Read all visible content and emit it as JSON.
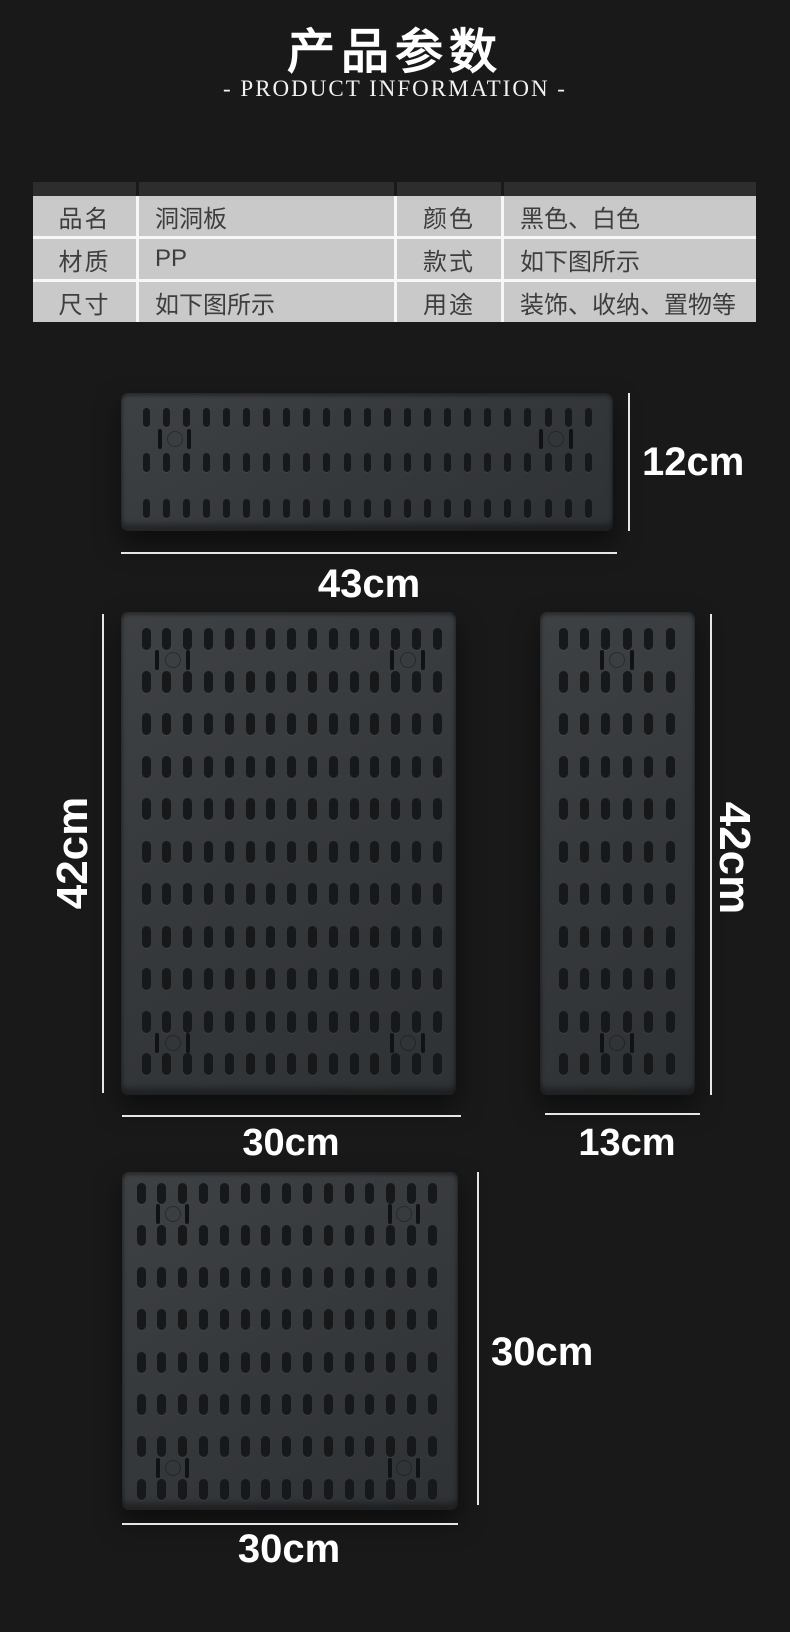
{
  "page": {
    "background": "#191919",
    "panel_gray": "#c9c9c9",
    "board_gray": "#36393c",
    "line_white": "#e6e6e6"
  },
  "header": {
    "title": "产品参数",
    "subtitle": "- PRODUCT INFORMATION -"
  },
  "spec_table": {
    "cells": [
      {
        "label": "品名",
        "value": "洞洞板"
      },
      {
        "label": "颜色",
        "value": "黑色、白色"
      },
      {
        "label": "材质",
        "value": "PP"
      },
      {
        "label": "款式",
        "value": "如下图所示"
      },
      {
        "label": "尺寸",
        "value": "如下图所示"
      },
      {
        "label": "用途",
        "value": "装饰、收纳、置物等"
      }
    ]
  },
  "boards": [
    {
      "name": "pegboard-43x12",
      "width_label": "43cm",
      "height_label": "12cm",
      "x": 121,
      "y": 393,
      "w": 492,
      "h": 138,
      "rows": 3,
      "cols": 23,
      "rowStart": 24,
      "rowPitch": 45.5,
      "colStart": 25,
      "colPitch": 20.1,
      "slotW": 7,
      "slotH": 19,
      "mounts": [
        {
          "y": 46,
          "xs": [
            39,
            68
          ]
        },
        {
          "y": 46,
          "xs": [
            420,
            450
          ]
        }
      ]
    },
    {
      "name": "pegboard-30x42",
      "width_label": "30cm",
      "height_label": "42cm",
      "x": 121,
      "y": 612,
      "w": 335,
      "h": 483,
      "rows": 11,
      "cols": 15,
      "rowStart": 27,
      "rowPitch": 42.5,
      "colStart": 25,
      "colPitch": 20.8,
      "slotW": 9,
      "slotH": 22,
      "mounts": [
        {
          "y": 48,
          "xs": [
            36,
            67
          ]
        },
        {
          "y": 48,
          "xs": [
            271,
            302
          ]
        },
        {
          "y": 431,
          "xs": [
            36,
            67
          ]
        },
        {
          "y": 431,
          "xs": [
            271,
            302
          ]
        }
      ]
    },
    {
      "name": "pegboard-13x42",
      "width_label": "13cm",
      "height_label": "42cm",
      "x": 540,
      "y": 612,
      "w": 155,
      "h": 483,
      "rows": 11,
      "cols": 6,
      "rowStart": 27,
      "rowPitch": 42.5,
      "colStart": 23,
      "colPitch": 21.4,
      "slotW": 9,
      "slotH": 22,
      "mounts": [
        {
          "y": 48,
          "xs": [
            62,
            92
          ]
        },
        {
          "y": 431,
          "xs": [
            62,
            92
          ]
        }
      ]
    },
    {
      "name": "pegboard-30x30",
      "width_label": "30cm",
      "height_label": "30cm",
      "x": 122,
      "y": 1172,
      "w": 336,
      "h": 338,
      "rows": 8,
      "cols": 15,
      "rowStart": 21,
      "rowPitch": 42.3,
      "colStart": 19,
      "colPitch": 20.8,
      "slotW": 9,
      "slotH": 21,
      "mounts": [
        {
          "y": 42,
          "xs": [
            36,
            65
          ]
        },
        {
          "y": 42,
          "xs": [
            268,
            296
          ]
        },
        {
          "y": 296,
          "xs": [
            36,
            65
          ]
        },
        {
          "y": 296,
          "xs": [
            268,
            296
          ]
        }
      ]
    }
  ],
  "dimensions": [
    {
      "label": "12cm",
      "type": "vline",
      "x": 628,
      "y1": 393,
      "y2": 531,
      "tx": 642,
      "ty": 462,
      "fs": 40,
      "rot": 0,
      "anchor": "lm"
    },
    {
      "label": "43cm",
      "type": "hline",
      "y": 552,
      "x1": 121,
      "x2": 617,
      "tx": 369,
      "ty": 564,
      "fs": 40,
      "rot": 0,
      "anchor": "ct"
    },
    {
      "label": "42cm",
      "type": "vline",
      "x": 102,
      "y1": 614,
      "y2": 1093,
      "tx": 73,
      "ty": 853,
      "fs": 44,
      "rot": -90,
      "anchor": "cm"
    },
    {
      "label": "42cm",
      "type": "vline",
      "x": 710,
      "y1": 614,
      "y2": 1095,
      "tx": 734,
      "ty": 858,
      "fs": 44,
      "rot": 90,
      "anchor": "cm"
    },
    {
      "label": "30cm",
      "type": "hline",
      "y": 1115,
      "x1": 122,
      "x2": 461,
      "tx": 291,
      "ty": 1124,
      "fs": 38,
      "rot": 0,
      "anchor": "ct"
    },
    {
      "label": "13cm",
      "type": "hline",
      "y": 1113,
      "x1": 545,
      "x2": 700,
      "tx": 627,
      "ty": 1124,
      "fs": 38,
      "rot": 0,
      "anchor": "ct"
    },
    {
      "label": "30cm",
      "type": "vline",
      "x": 477,
      "y1": 1172,
      "y2": 1505,
      "tx": 491,
      "ty": 1352,
      "fs": 40,
      "rot": 0,
      "anchor": "lm"
    },
    {
      "label": "30cm",
      "type": "hline",
      "y": 1523,
      "x1": 122,
      "x2": 458,
      "tx": 289,
      "ty": 1529,
      "fs": 40,
      "rot": 0,
      "anchor": "ct"
    }
  ]
}
